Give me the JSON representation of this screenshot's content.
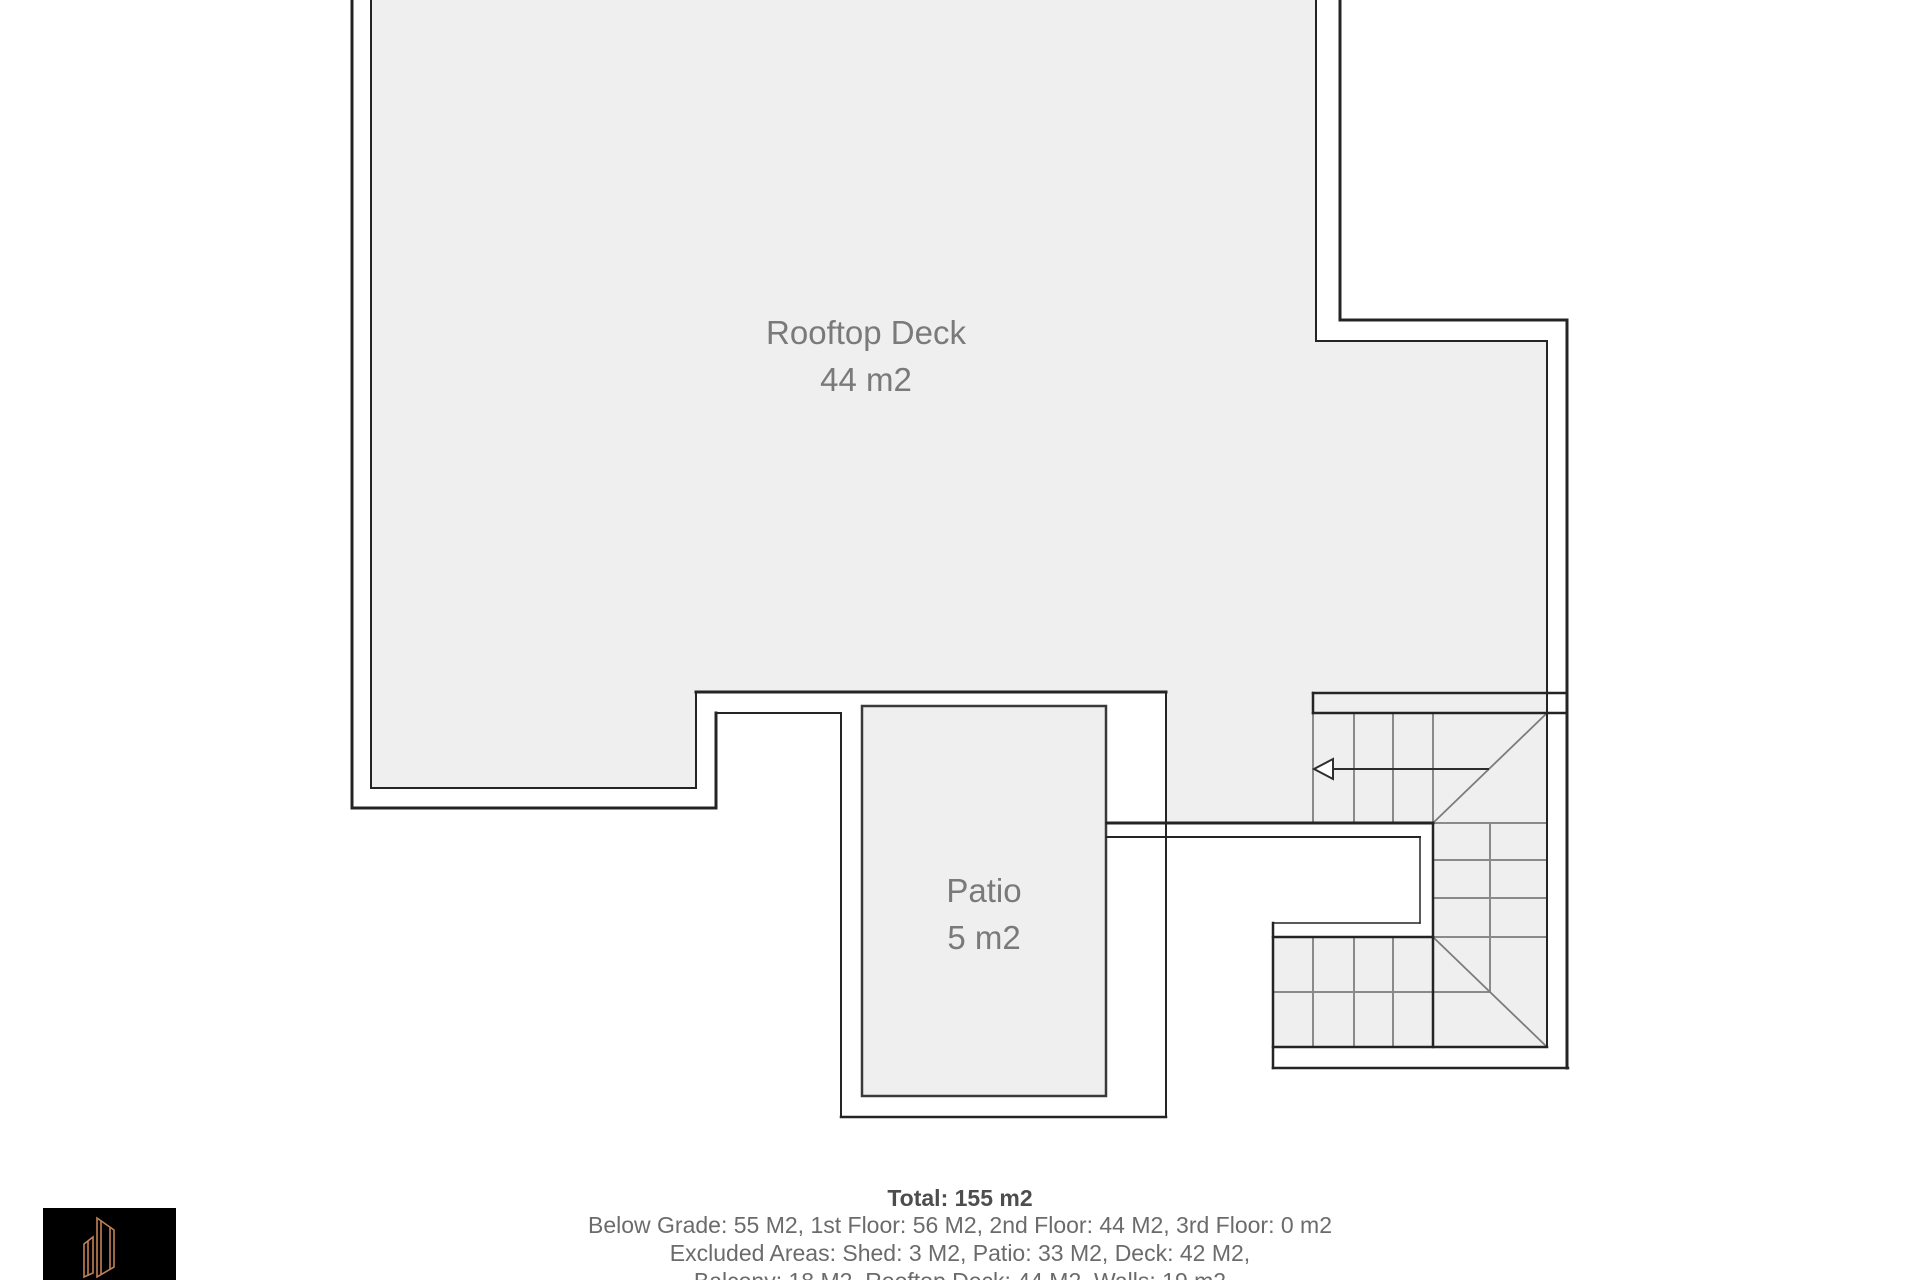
{
  "plan": {
    "title": "rooftop-floor-plan",
    "rooms": {
      "rooftop_deck": {
        "name": "Rooftop Deck",
        "area": "44 m2"
      },
      "patio": {
        "name": "Patio",
        "area": "5 m2"
      }
    },
    "stairs": {
      "direction_icon": "arrow-left"
    }
  },
  "summary": {
    "total": "Total: 155 m2",
    "floors": "Below Grade: 55 M2, 1st Floor: 56 M2, 2nd Floor: 44 M2, 3rd Floor: 0 m2",
    "excluded_1": "Excluded Areas: Shed: 3 M2, Patio: 33 M2, Deck: 42 M2,",
    "excluded_2": "Balcony: 18 M2, Rooftop Deck: 44 M2, Walls: 19 m2"
  },
  "logo": {
    "icon": "building-outline-logo"
  },
  "colors": {
    "room_fill": "#efefef",
    "wall": "#242424",
    "stair_line": "#8a8a8a",
    "label_text": "#7a7a7a",
    "summary_text": "#6b6b6b",
    "summary_total_text": "#4d4d4d",
    "logo_background": "#000000",
    "logo_accent": "#c28155"
  }
}
